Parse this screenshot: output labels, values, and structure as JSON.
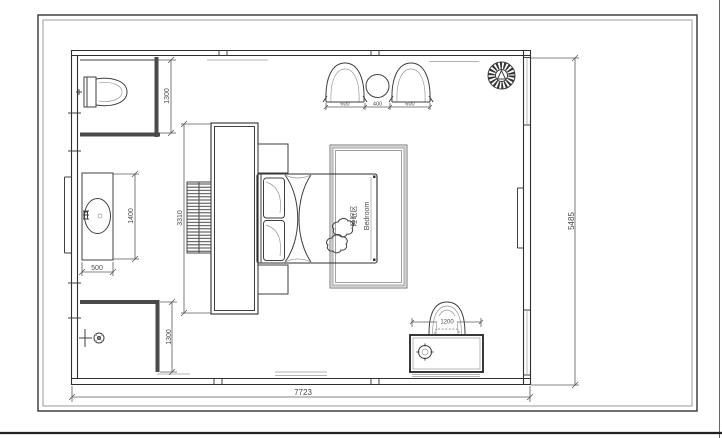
{
  "plan": {
    "room_label": {
      "cn": "睡眠区",
      "en": "Bedroom"
    },
    "dimensions": {
      "overall_width": "7723",
      "overall_height": "5485",
      "wc_depth": "1300",
      "shower_depth": "1300",
      "vanity_length": "1400",
      "vanity_width": "500",
      "cabinet_length": "3310",
      "armchair_left": "600",
      "tea_table": "400",
      "armchair_right": "600",
      "desk_width": "1200"
    },
    "colors": {
      "line": "#3f3f3f",
      "wall": "#4a4a4a",
      "rug_border": "#b5b5b5",
      "background": "#ffffff"
    }
  }
}
